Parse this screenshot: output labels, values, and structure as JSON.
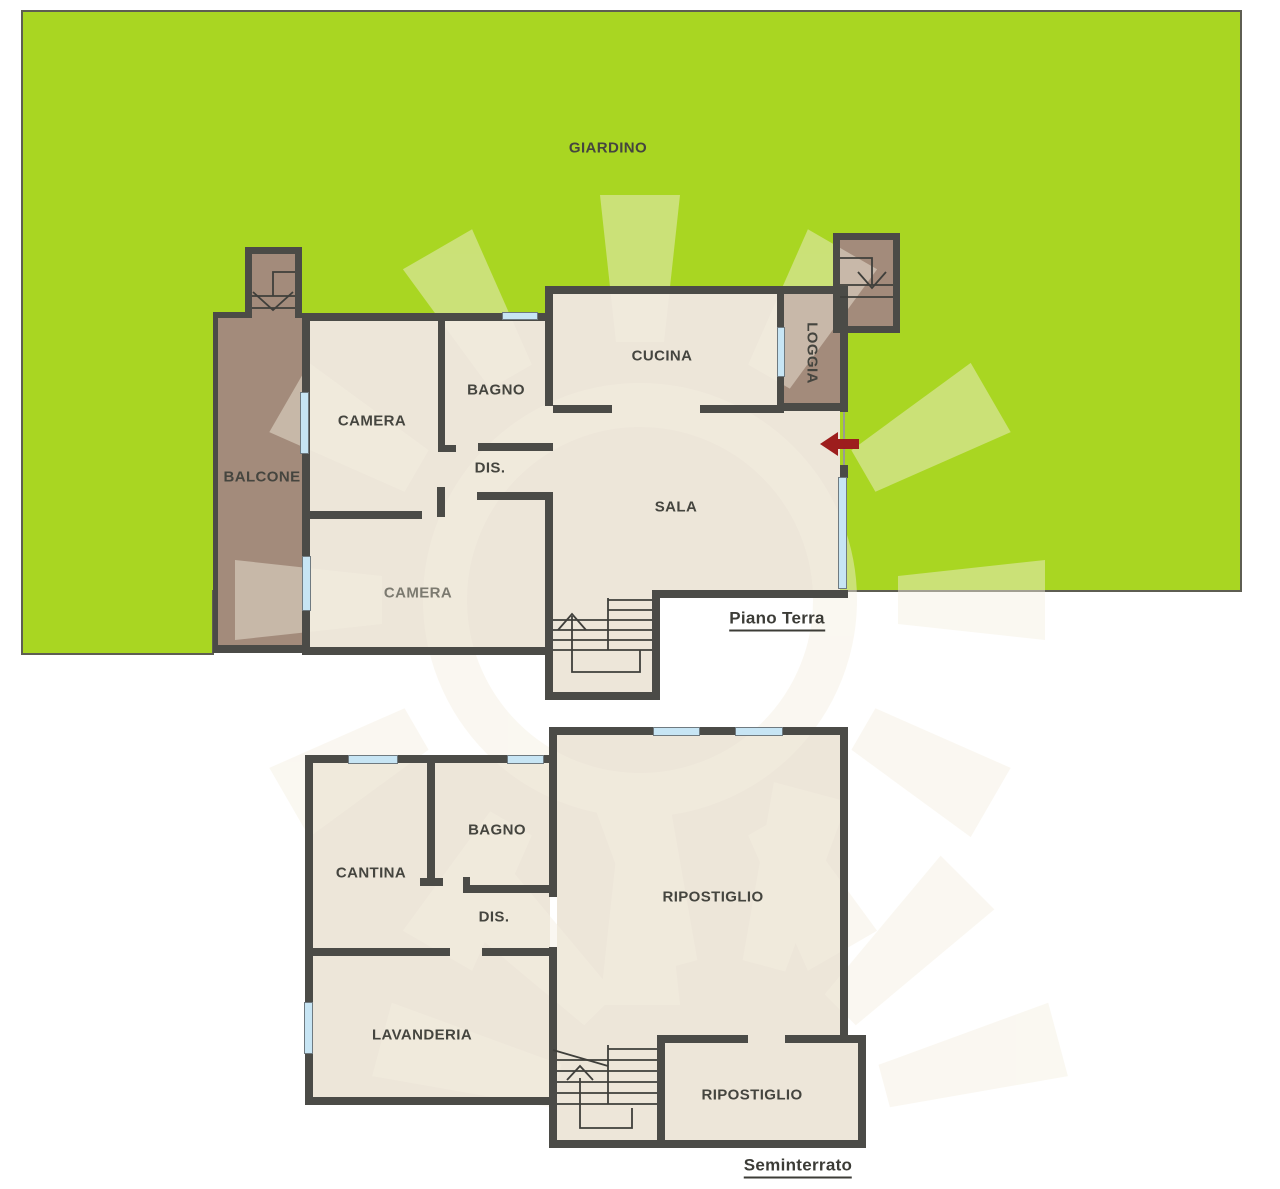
{
  "garden": {
    "label": "GIARDINO"
  },
  "ground_floor": {
    "title": "Piano Terra",
    "rooms": [
      {
        "label": "BALCONE"
      },
      {
        "label": "CAMERA"
      },
      {
        "label": "BAGNO"
      },
      {
        "label": "DIS."
      },
      {
        "label": "CUCINA"
      },
      {
        "label": "LOGGIA"
      },
      {
        "label": "SALA"
      },
      {
        "label": "CAMERA"
      }
    ],
    "entrance_arrow": "entrance"
  },
  "basement": {
    "title": "Seminterrato",
    "rooms": [
      {
        "label": "CANTINA"
      },
      {
        "label": "BAGNO"
      },
      {
        "label": "DIS."
      },
      {
        "label": "RIPOSTIGLIO"
      },
      {
        "label": "LAVANDERIA"
      },
      {
        "label": "RIPOSTIGLIO"
      }
    ]
  },
  "colors": {
    "garden_green": "#a9d622",
    "garden_border": "#5e5e52",
    "wall_dark": "#4b4b47",
    "room_beige": "#ede6d9",
    "terrace_brown": "#a38b7b",
    "window_blue": "#c7e5f4",
    "entrance_arrow_red": "#9d1d1d",
    "label_gray": "#45453f",
    "watermark_cream": "#f5efe1"
  }
}
